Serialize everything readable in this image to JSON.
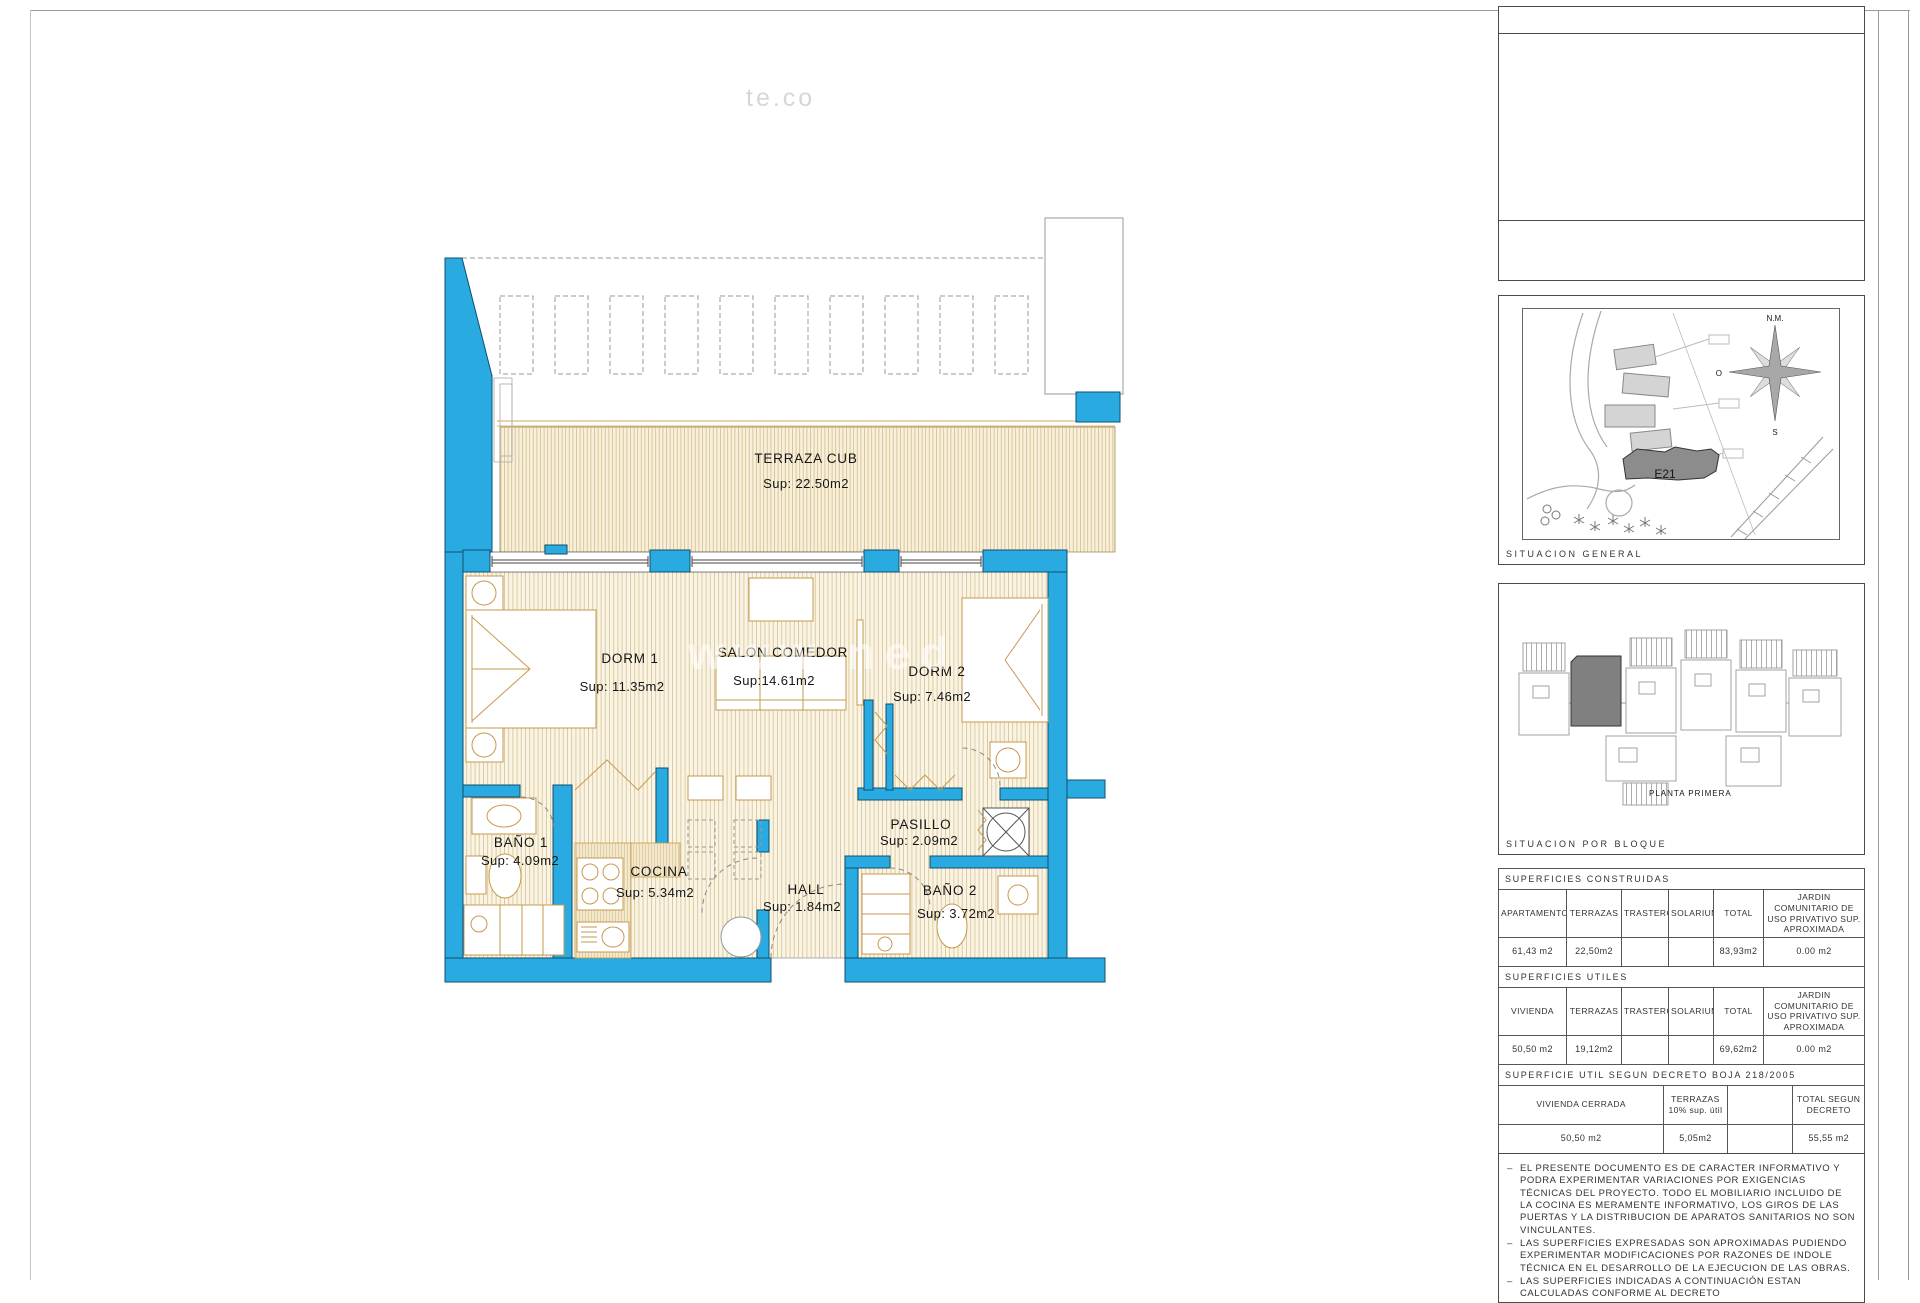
{
  "plan": {
    "rooms": [
      {
        "name": "TERRAZA CUB",
        "area": "Sup: 22.50m2"
      },
      {
        "name": "DORM 1",
        "area": "Sup: 11.35m2"
      },
      {
        "name": "SALON COMEDOR",
        "area": "Sup:14.61m2"
      },
      {
        "name": "DORM 2",
        "area": "Sup: 7.46m2"
      },
      {
        "name": "BAÑO 1",
        "area": "Sup: 4.09m2"
      },
      {
        "name": "COCINA",
        "area": "Sup: 5.34m2"
      },
      {
        "name": "HALL",
        "area": "Sup: 1.84m2"
      },
      {
        "name": "PASILLO",
        "area": "Sup: 2.09m2"
      },
      {
        "name": "BAÑO 2",
        "area": "Sup: 3.72m2"
      }
    ],
    "watermark_top": "te.co",
    "watermark_middle": "www.ned"
  },
  "colors": {
    "wall_fill": "#29abe2",
    "wall_stroke": "#0d4f6e",
    "floor_hatch": "#d6c193",
    "furniture": "#c69a4e"
  },
  "sidebar": {
    "situacion_general": {
      "label": "SITUACION GENERAL",
      "building_tag": "E21",
      "compass_north": "N.M.",
      "compass_west": "O",
      "compass_south": "S"
    },
    "situacion_bloque": {
      "label": "SITUACION POR BLOQUE",
      "caption": "PLANTA PRIMERA"
    },
    "tables": {
      "constructed": {
        "title": "SUPERFICIES CONSTRUIDAS",
        "headers": [
          "APARTAMENTO",
          "TERRAZAS",
          "TRASTERO",
          "SOLARIUM",
          "TOTAL",
          "JARDIN COMUNITARIO DE USO PRIVATIVO SUP. APROXIMADA"
        ],
        "values": [
          "61,43 m2",
          "22,50m2",
          "",
          "",
          "83,93m2",
          "0.00 m2"
        ]
      },
      "useful": {
        "title": "SUPERFICIES UTILES",
        "headers": [
          "VIVIENDA",
          "TERRAZAS",
          "TRASTERO",
          "SOLARIUM",
          "TOTAL",
          "JARDIN COMUNITARIO DE USO PRIVATIVO SUP. APROXIMADA"
        ],
        "values": [
          "50,50 m2",
          "19,12m2",
          "",
          "",
          "69,62m2",
          "0.00 m2"
        ]
      },
      "decree": {
        "title": "SUPERFICIE UTIL SEGUN DECRETO BOJA 218/2005",
        "headers": [
          "VIVIENDA CERRADA",
          "TERRAZAS 10% sup. útil",
          "",
          "TOTAL SEGUN DECRETO"
        ],
        "values": [
          "50,50 m2",
          "5,05m2",
          "",
          "55,55 m2"
        ]
      }
    },
    "note_bullet": "–",
    "notes": [
      "EL PRESENTE DOCUMENTO ES DE CARACTER INFORMATIVO Y PODRA EXPERIMENTAR VARIACIONES POR EXIGENCIAS TÉCNICAS DEL PROYECTO. TODO EL MOBILIARIO INCLUIDO DE LA COCINA ES MERAMENTE INFORMATIVO, LOS GIROS DE LAS PUERTAS Y LA DISTRIBUCION DE APARATOS SANITARIOS NO SON VINCULANTES.",
      "LAS SUPERFICIES EXPRESADAS SON APROXIMADAS PUDIENDO EXPERIMENTAR MODIFICACIONES POR RAZONES DE INDOLE TÉCNICA EN EL DESARROLLO DE LA EJECUCION DE LAS OBRAS.",
      "LAS SUPERFICIES INDICADAS A CONTINUACIÓN ESTAN CALCULADAS CONFORME AL DECRETO"
    ]
  }
}
